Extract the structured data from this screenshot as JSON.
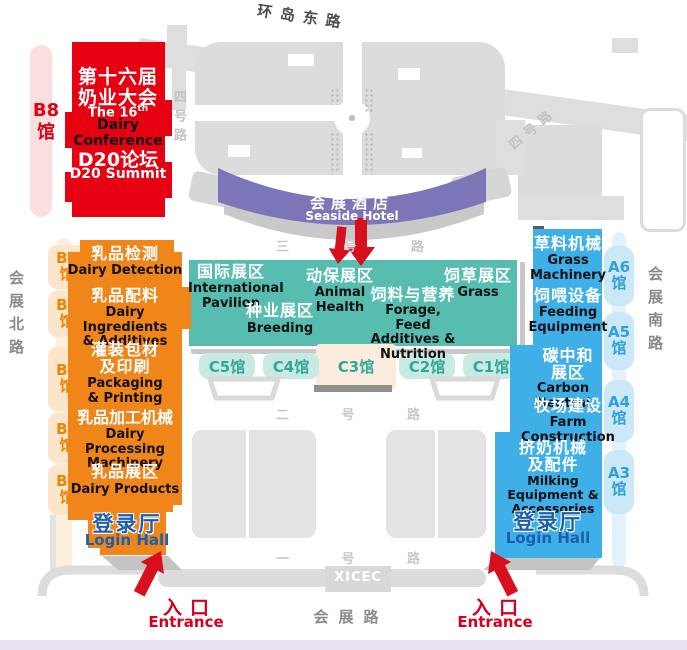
{
  "title": "XICEC dairy exhibition venue map",
  "colors": {
    "red_block": "#E60012",
    "pink_strip": "#FBDEDE",
    "purple_hotel": "#7C76B9",
    "teal_block": "#58BDB1",
    "teal_pill_bg": "#C9E9E3",
    "teal_pill_text": "#2FA899",
    "orange_block": "#F08519",
    "orange_pill_bg": "#FBE6CB",
    "orange_pill_text": "#F08300",
    "blue_block": "#3FAFE8",
    "blue_pill_bg": "#CBE8F7",
    "blue_pill_text": "#2FA0DB",
    "login_text": "#1D5FAD",
    "entrance_red": "#D6001E",
    "road_gray": "#DEDEDE",
    "lavender_strip": "#E7E1F3"
  },
  "roads": {
    "top": "环岛东路",
    "no4": "四号路",
    "no3": [
      "三",
      "号",
      "路"
    ],
    "no2": [
      "二",
      "号",
      "路"
    ],
    "no1": [
      "一",
      "号",
      "路"
    ],
    "north": "会展北路",
    "south": "会展南路",
    "bottom": "会展路",
    "xicec": "XICEC"
  },
  "conference": {
    "hall_line1": "B8",
    "hall_line2": "馆",
    "cn1": "第十六届",
    "cn2": "奶业大会",
    "en_prefix": "The 16",
    "en_sup": "th",
    "en2": "Dairy Conference",
    "summit_cn": "D20论坛",
    "summit_en": "D20 Summit"
  },
  "hotel": {
    "cn": "会展酒店",
    "en": "Seaside Hotel"
  },
  "center_zones": {
    "intl": {
      "cn": "国际展区",
      "en": "International\nPavilion"
    },
    "breeding": {
      "cn": "种业展区",
      "en": "Breeding"
    },
    "animal": {
      "cn": "动保展区",
      "en": "Animal\nHealth"
    },
    "forage": {
      "cn": "饲料与营养",
      "en": "Forage, Feed\nAdditives &\nNutrition"
    },
    "grass": {
      "cn": "饲草展区",
      "en": "Grass"
    }
  },
  "c_halls": [
    "C5馆",
    "C4馆",
    "C3馆",
    "C2馆",
    "C1馆"
  ],
  "b_halls": [
    {
      "l1": "B7",
      "l2": "馆"
    },
    {
      "l1": "B6",
      "l2": "馆"
    },
    {
      "l1": "B5",
      "l2": "馆"
    },
    {
      "l1": "B4",
      "l2": "馆"
    },
    {
      "l1": "B3",
      "l2": "馆"
    }
  ],
  "a_halls": [
    {
      "l1": "A6",
      "l2": "馆"
    },
    {
      "l1": "A5",
      "l2": "馆"
    },
    {
      "l1": "A4",
      "l2": "馆"
    },
    {
      "l1": "A3",
      "l2": "馆"
    }
  ],
  "west_zones": {
    "detection": {
      "cn": "乳品检测",
      "en": "Dairy Detection"
    },
    "ingredients": {
      "cn": "乳品配料",
      "en": "Dairy Ingredients\n& Additives"
    },
    "packaging": {
      "cn": "灌装包材\n及印刷",
      "en": "Packaging\n& Printing"
    },
    "processing": {
      "cn": "乳品加工机械",
      "en": "Dairy Processing\nMachinery"
    },
    "products": {
      "cn": "乳品展区",
      "en": "Dairy Products"
    }
  },
  "east_zones": {
    "grass_machinery": {
      "cn": "草料机械",
      "en": "Grass\nMachinery"
    },
    "feeding": {
      "cn": "饲喂设备",
      "en": "Feeding\nEquipment"
    },
    "carbon": {
      "cn": "碳中和\n展区",
      "en": "Carbon Neutral"
    },
    "farm": {
      "cn": "牧场建设",
      "en": "Farm\nConstruction"
    },
    "milking": {
      "cn": "挤奶机械\n及配件",
      "en": "Milking Equipment &\nAccessories"
    }
  },
  "login_hall": {
    "cn": "登录厅",
    "en": "Login Hall"
  },
  "entrance": {
    "cn": "入口",
    "en": "Entrance"
  }
}
